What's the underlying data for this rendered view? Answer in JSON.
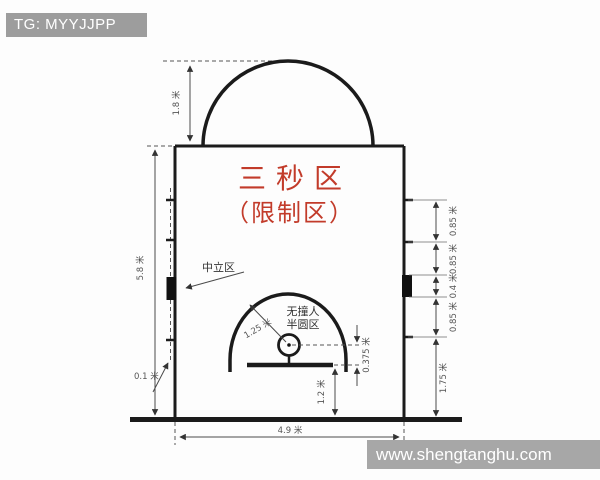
{
  "badge": {
    "label": "TG: MYYJJPP"
  },
  "watermark": {
    "url_text": "www.shengtanghu.com"
  },
  "diagram": {
    "title_line1": "三秒区",
    "title_line2": "（限制区）",
    "neutral_zone_label": "中立区",
    "no_charge_label_line1": "无撞人",
    "no_charge_label_line2": "半圆区",
    "dims": {
      "dome_depth": "1.8 米",
      "lane_length": "5.8 米",
      "line_width": "0.1 米",
      "no_charge_radius": "1.25 米",
      "ring_to_backboard": "0.375 米",
      "backboard_to_endline": "1.2 米",
      "lane_width": "4.9 米",
      "right_segments": [
        "0.85 米",
        "0.85 米",
        "0.4 米",
        "0.85 米",
        "1.75 米"
      ]
    }
  },
  "colors": {
    "accent_red": "#c23b2a",
    "court_line": "#1b1b1b",
    "dimension_gray": "#4a4a4a",
    "overlay_gray": "#a7a7a7",
    "background": "#fdfdfd"
  }
}
